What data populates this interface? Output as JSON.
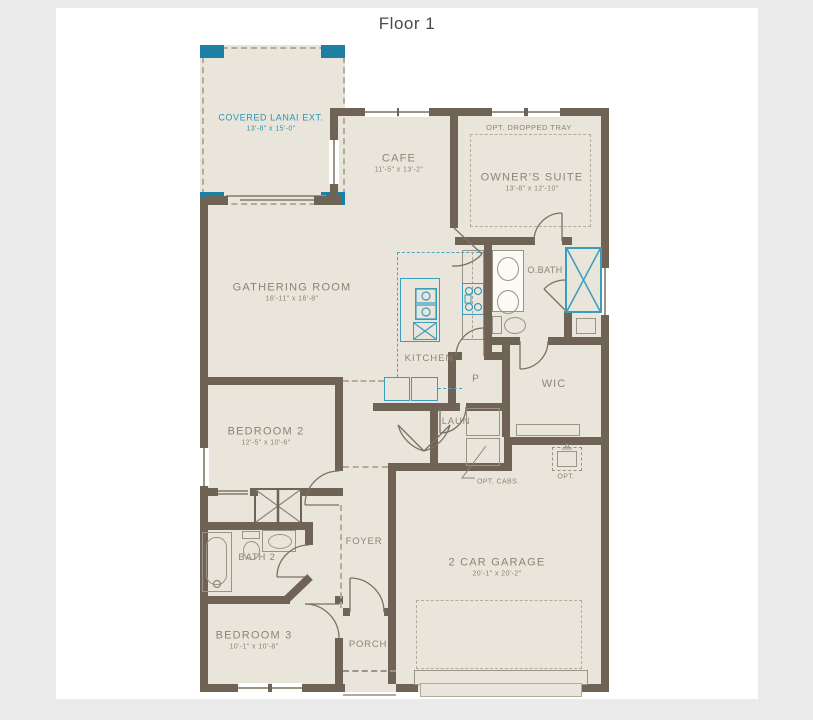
{
  "title": "Floor 1",
  "rooms": {
    "lanai": {
      "name": "COVERED LANAI EXT.",
      "dims": "13'-8\" x 15'-0\""
    },
    "cafe": {
      "name": "CAFE",
      "dims": "11'-5\" x 13'-2\""
    },
    "owners_suite": {
      "name": "OWNER'S SUITE",
      "dims": "13'-8\" x 12'-10\""
    },
    "gathering": {
      "name": "GATHERING ROOM",
      "dims": "16'-11\" x 16'-8\""
    },
    "kitchen": {
      "name": "KITCHEN"
    },
    "pantry": {
      "name": "P"
    },
    "obath": {
      "name": "O.BATH"
    },
    "wic": {
      "name": "WIC"
    },
    "laundry": {
      "name": "LAUN"
    },
    "bedroom2": {
      "name": "BEDROOM 2",
      "dims": "12'-5\" x 10'-6\""
    },
    "bath2": {
      "name": "BATH 2"
    },
    "bedroom3": {
      "name": "BEDROOM 3",
      "dims": "10'-1\" x 10'-8\""
    },
    "foyer": {
      "name": "FOYER"
    },
    "porch": {
      "name": "PORCH"
    },
    "garage": {
      "name": "2 CAR GARAGE",
      "dims": "20'-1\" x 20'-2\""
    }
  },
  "annotations": {
    "dropped_tray": "OPT. DROPPED TRAY",
    "opt_cabs": "OPT. CABS.",
    "opt_sink": "OPT."
  },
  "colors": {
    "wall": "#6f6355",
    "floor": "#e9e5da",
    "accent_teal": "#2e93b4",
    "corner_post_teal": "#1d7fa4",
    "label_gray": "#8b8478",
    "page_bg": "#ebebeb"
  }
}
